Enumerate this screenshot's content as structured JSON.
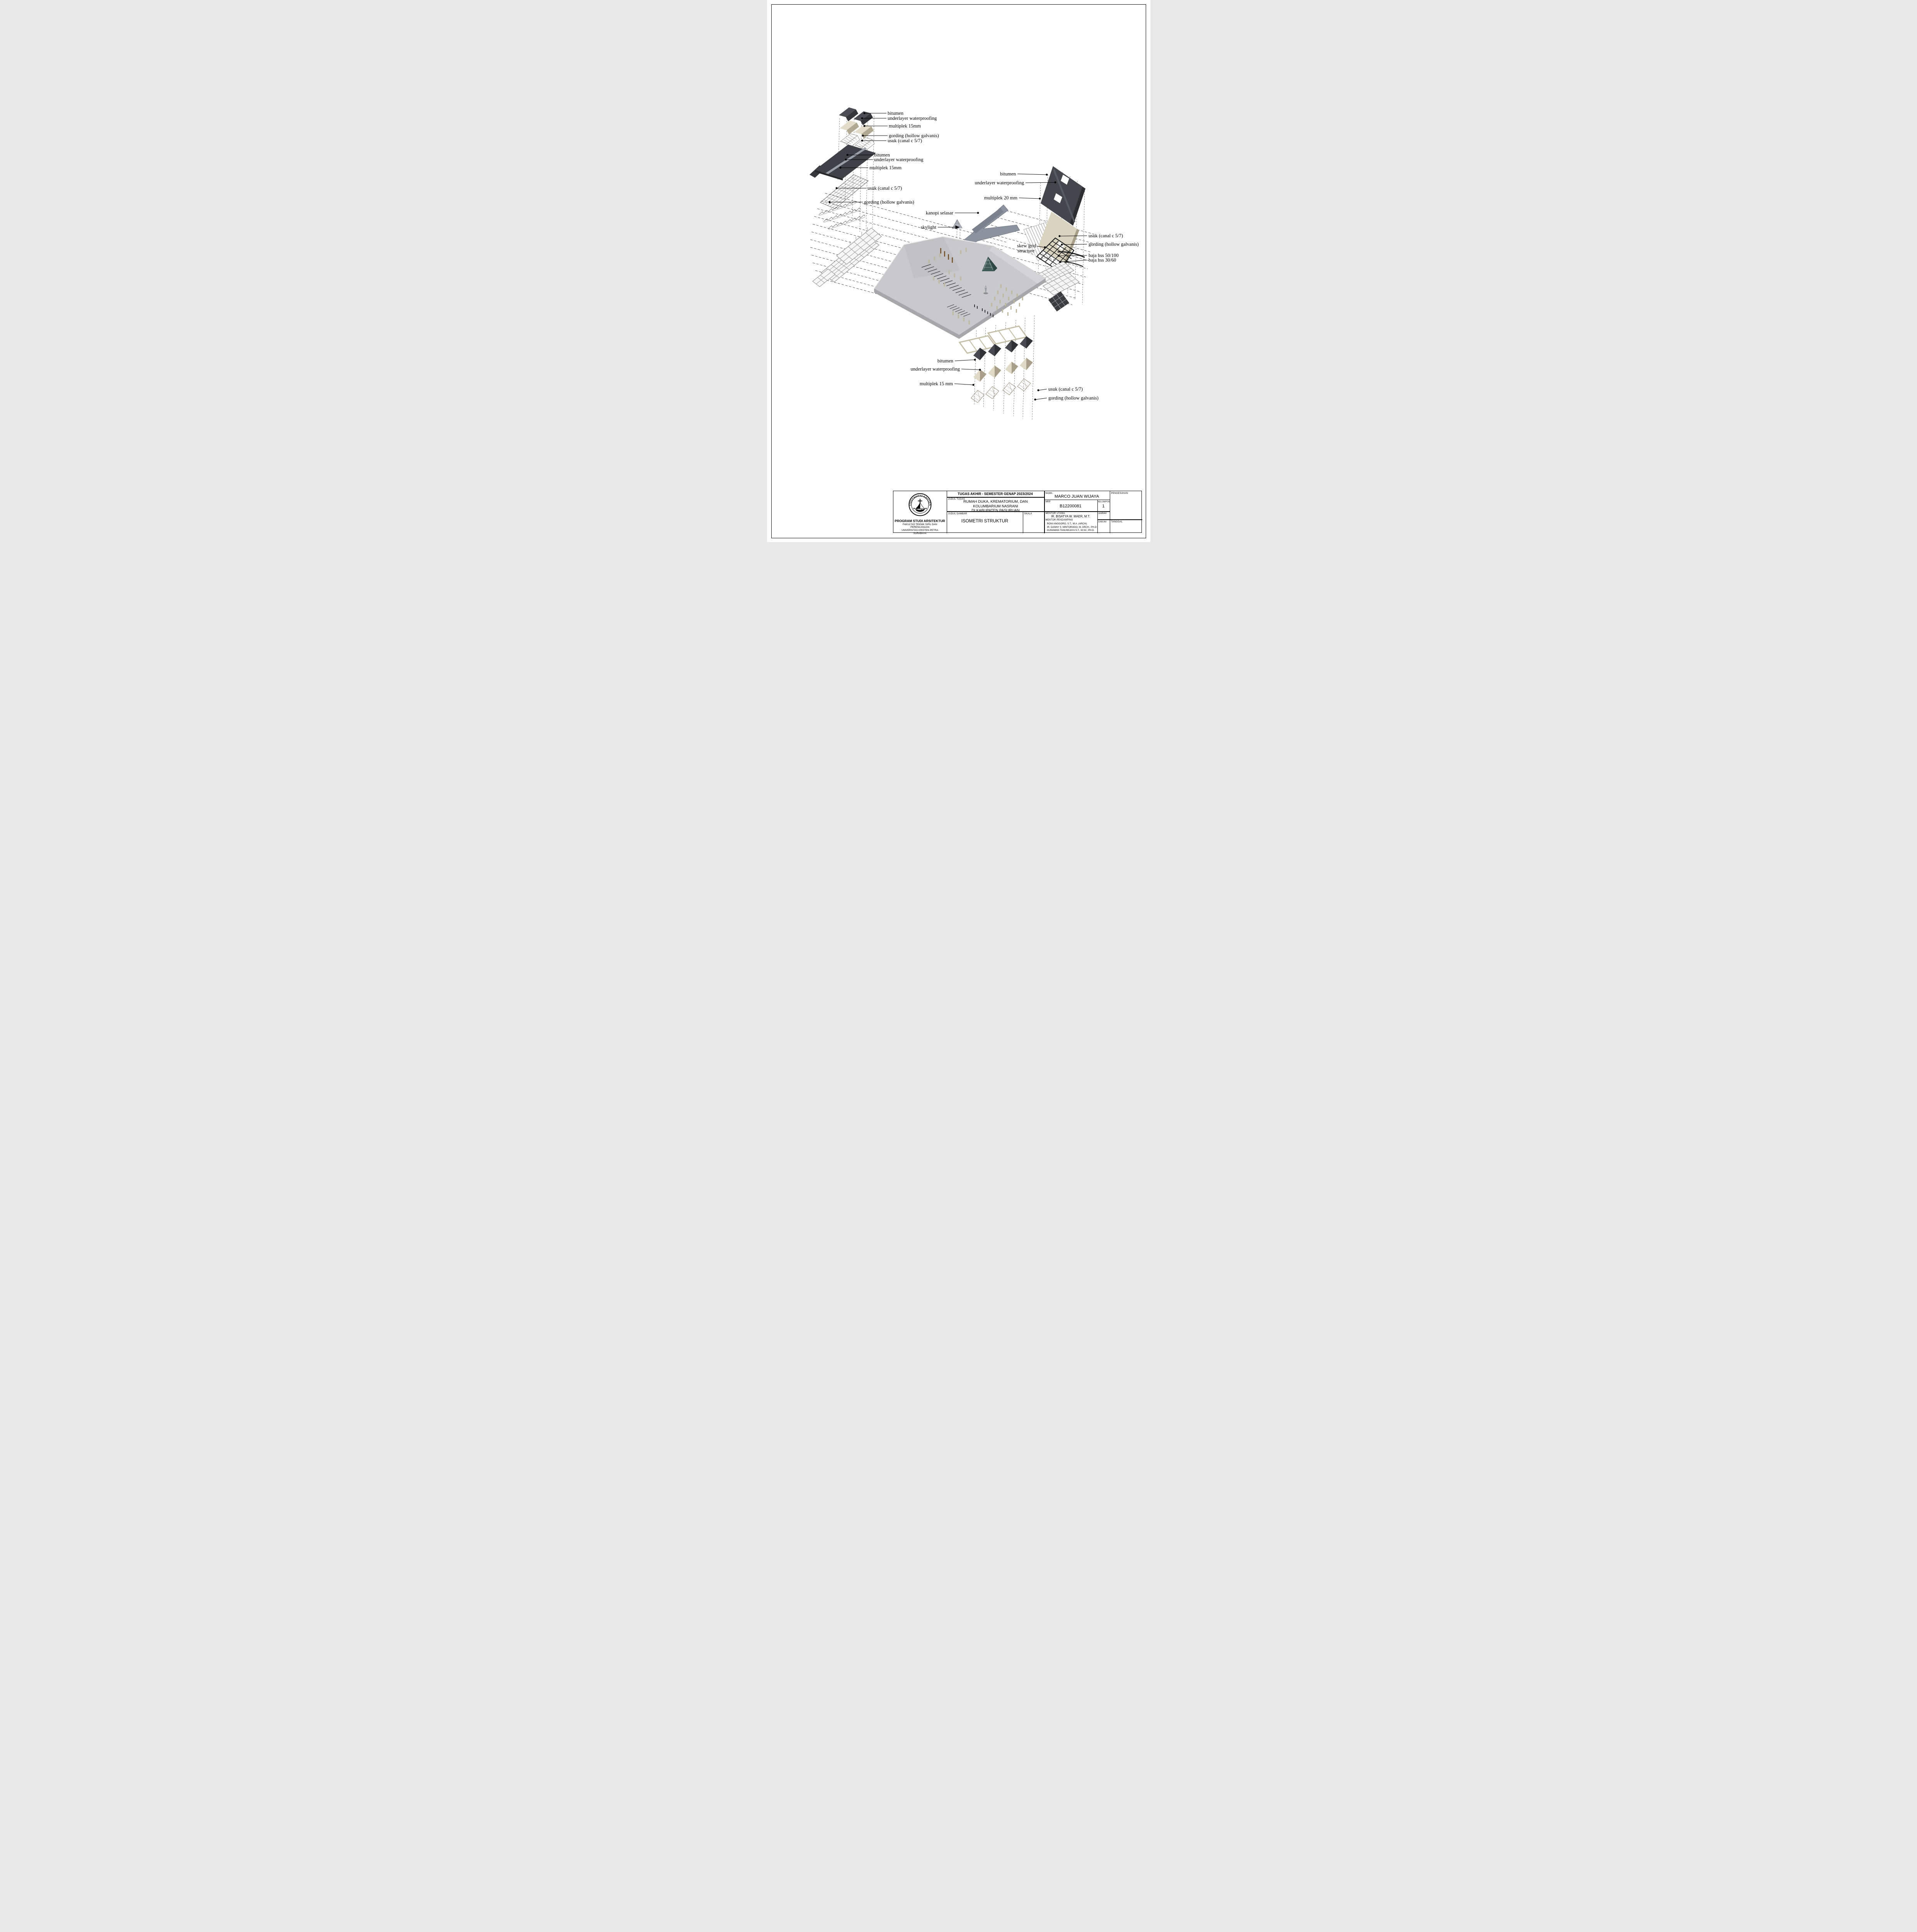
{
  "sheet": {
    "titleblock": {
      "institution": {
        "logo_text_top": "UNIVERSITAS KRISTEN",
        "logo_text_bottom": "PETRA",
        "program": "PROGRAM STUDI ARSITEKTUR",
        "faculty": "FAKULTAS TEKNIK SIPIL DAN PERENCANAAN",
        "university": "UNIVERSITAS KRISTEN PETRA",
        "city": "SURABAYA"
      },
      "header": "TUGAS AKHIR - SEMESTER GENAP 2023/2024",
      "judul_tugas_label": "JUDUL TUGAS",
      "judul_tugas_lines": [
        "RUMAH DUKA, KREMATORIUM, DAN",
        "KOLUMBARIUM NASRANI",
        "DI KABUPATEN PASURUAN"
      ],
      "judul_gambar_label": "JUDUL GAMBAR",
      "judul_gambar": "ISOMETRI STRUKTUR",
      "skala_label": "SKALA",
      "nama_label": "NAMA",
      "nama": "MARCO JUAN WIJAYA",
      "nrp_label": "NRP",
      "nrp": "B12200081",
      "kelompok_label": "KELOMPOK",
      "kelompok": "1",
      "pengesahan_label": "PENGESAHAN",
      "mentor_utama_label": "MENTOR UTAMA",
      "mentor_utama": "IR. BISATYA W. MAER, M.T.",
      "mentor_pendamping_label": "MENTOR PENDAMPING",
      "mentor_pendamping_lines": [
        "RONI ANGGORO, S.T., M.A. (ARCH)",
        "IR. DANNY S. MINTOROGO, M. ARCH., PH.D",
        "GUNAWAN TANUWIJAYA S.T., M.SC, PH.D."
      ],
      "lembar_label": "LEMBAR",
      "jumlah_label": "JUMLAH",
      "tanggal_label": "TANGGAL"
    },
    "diagram": {
      "stack_top_left_labels": [
        "bitumen",
        "underlayer waterproofing",
        "multiplek 15mm",
        "gording (hollow galvanis)",
        "usuk (canal c 5/7)"
      ],
      "stack_left_labels": [
        "bitumen",
        "underlayer waterproofing",
        "multiplek 15mm",
        "usuk (canal c 5/7)",
        "gording (hollow galvanis)"
      ],
      "canopy_label": "kanopi selasar",
      "skylight_label": "skylight",
      "stack_right_labels": [
        "bitumen",
        "underlayer waterproofing",
        "multiplek 20 mm",
        "usuk (canal c 5/7)",
        "gording (hollow galvanis)",
        "baja hss 50/100",
        "baja hss 30/60"
      ],
      "skew_grid_label_line1": "skew grid",
      "skew_grid_label_line2": "structure",
      "stack_bottom_labels": [
        "bitumen",
        "underlayer waterproofing",
        "multiplek 15 mm",
        "usuk (canal c 5/7)",
        "gording (hollow galvanis)"
      ]
    },
    "colors": {
      "bitumen": "#43464c",
      "multiplek": "#d9d2bf",
      "floor_plate": "#c9c9cb",
      "canopy": "#8b939f",
      "skylight_glass": "#3e5a56",
      "steel_frame": "#17181a",
      "paper": "#ffffff"
    }
  }
}
